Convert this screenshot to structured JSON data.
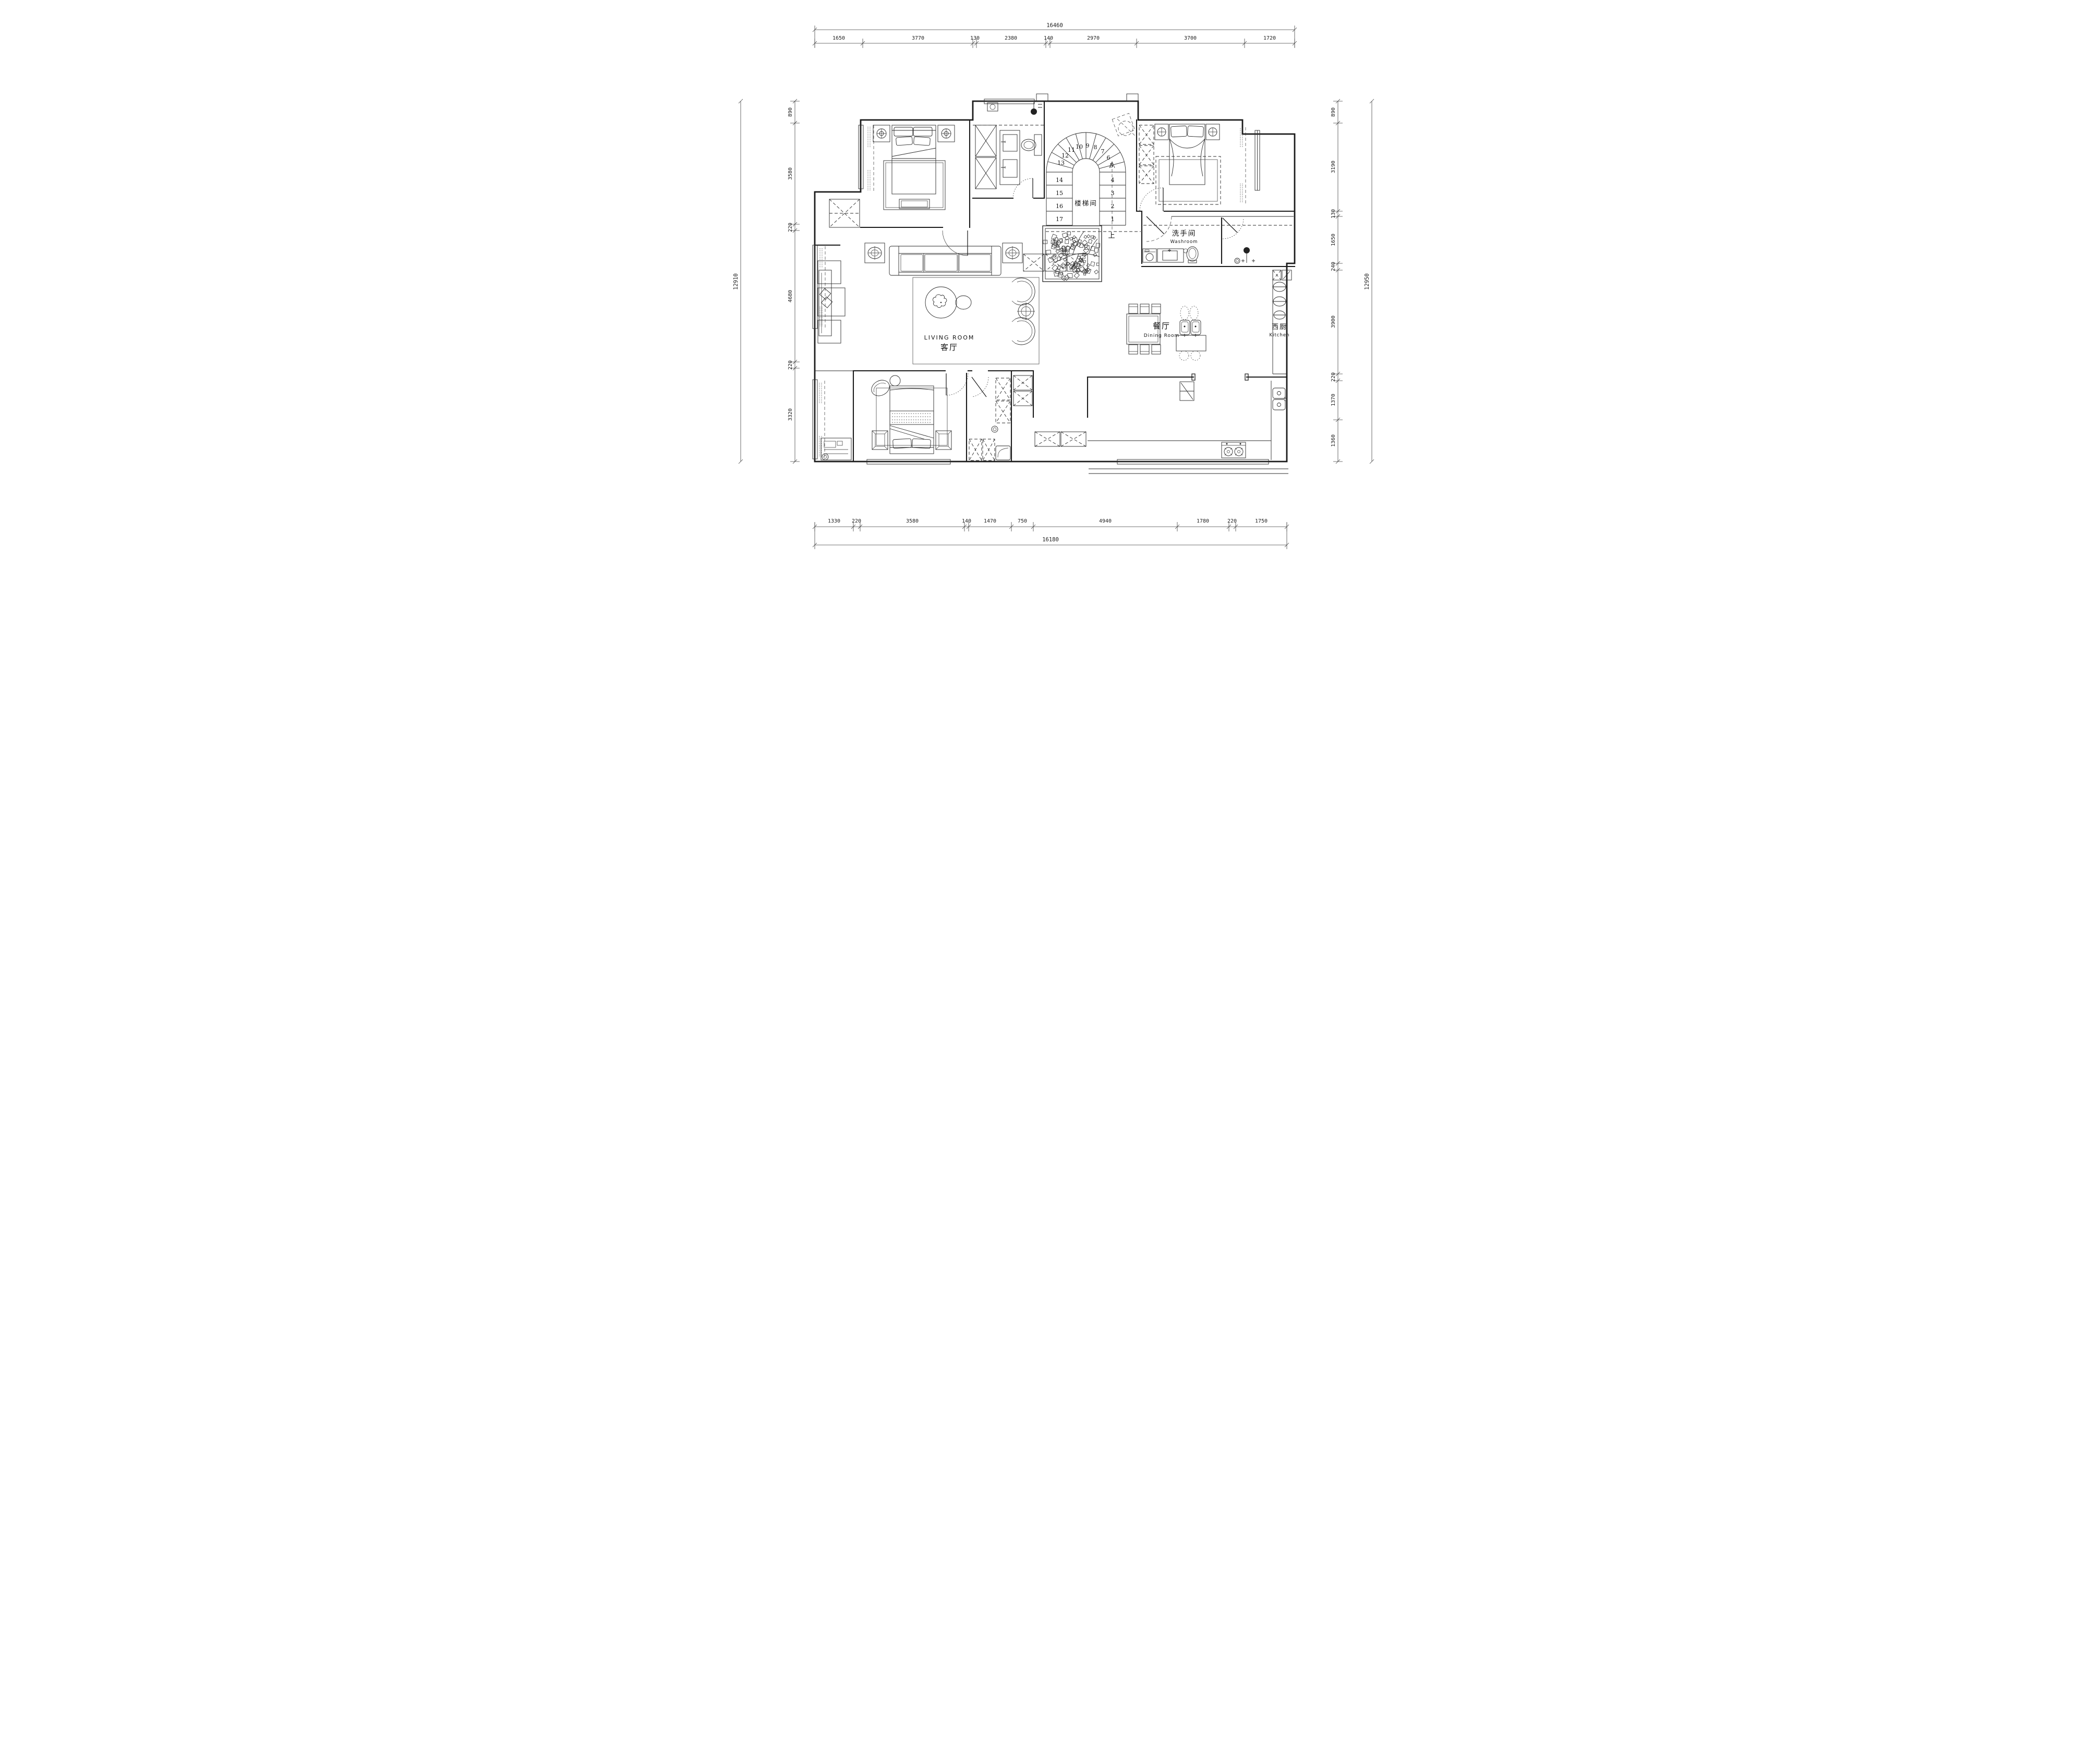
{
  "drawing": {
    "type": "residential floor plan",
    "units": "mm"
  },
  "dimensions": {
    "top": {
      "total": "16460",
      "segments": [
        "1650",
        "3770",
        "130",
        "2380",
        "140",
        "2970",
        "3700",
        "1720"
      ]
    },
    "bottom": {
      "total": "16180",
      "segments": [
        "1330",
        "220",
        "3580",
        "140",
        "1470",
        "750",
        "4940",
        "1780",
        "220",
        "1750"
      ]
    },
    "left": {
      "total": "12910",
      "segments": [
        "890",
        "3580",
        "220",
        "4680",
        "220",
        "3320"
      ]
    },
    "right": {
      "total": "12950",
      "segments": [
        "890",
        "3190",
        "130",
        "1650",
        "240",
        "3900",
        "220",
        "1370",
        "1360"
      ]
    }
  },
  "rooms": {
    "living": {
      "name_en": "LIVING ROOM",
      "name_zh": "客厅"
    },
    "dining": {
      "name_zh": "餐厅",
      "name_en": "Dining Room"
    },
    "washroom": {
      "name_zh": "洗手间",
      "name_en": "Washroom"
    },
    "kitchen": {
      "name_zh": "西厨",
      "name_en": "Kitchen"
    },
    "stairwell": {
      "name_zh": "楼梯间"
    },
    "up_label": "上"
  },
  "stairs": {
    "steps": [
      "1",
      "2",
      "3",
      "4",
      "5",
      "6",
      "7",
      "8",
      "9",
      "10",
      "11",
      "12",
      "13",
      "14",
      "15",
      "16",
      "17"
    ]
  }
}
